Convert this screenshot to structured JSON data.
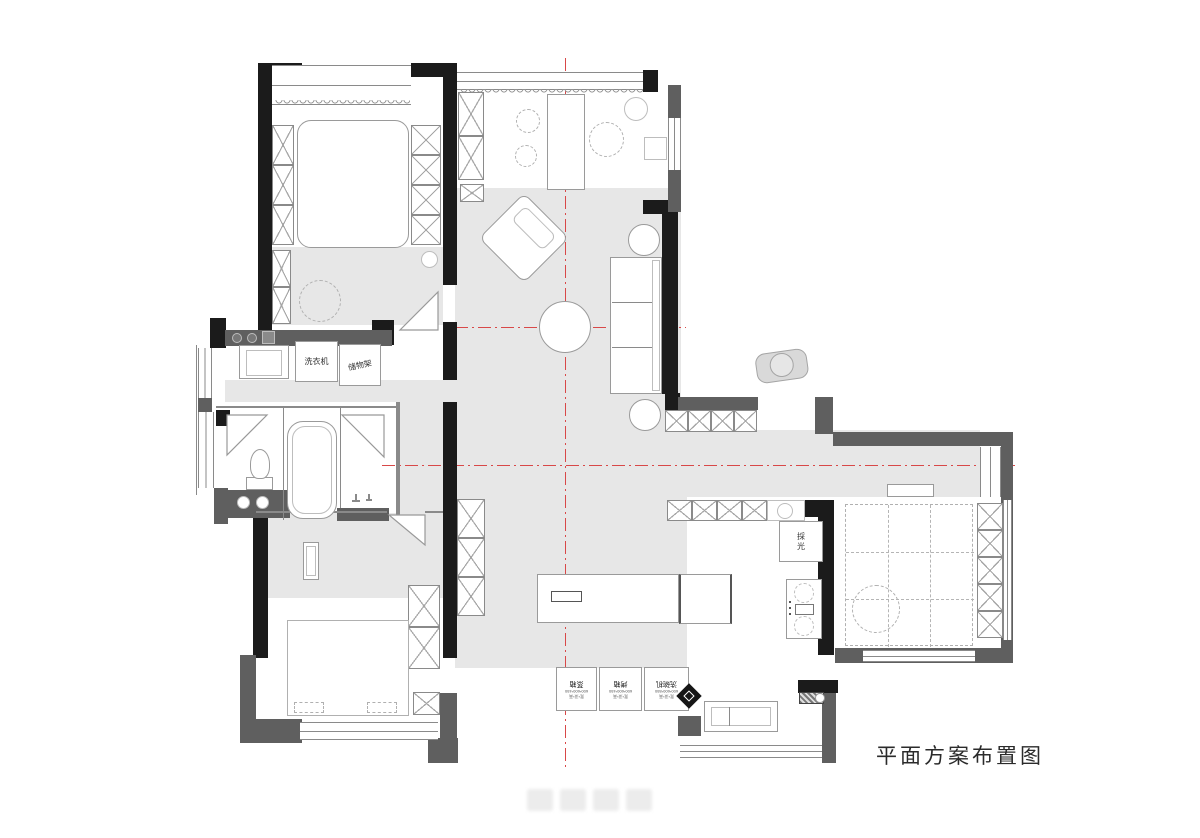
{
  "title": "平面方案布置图",
  "labels": {
    "washing_machine": "洗衣机",
    "storage_rack": "储物架",
    "daylight": "採光",
    "appliances": [
      {
        "spec": "宽*深*高",
        "dims": "600*600*450",
        "name": "蒸箱"
      },
      {
        "spec": "宽*深*高",
        "dims": "600*600*450",
        "name": "烤箱"
      },
      {
        "spec": "宽*深*高",
        "dims": "600*600*850",
        "name": "洗碗机"
      }
    ]
  },
  "colors": {
    "wall_primary": "#1b1b1b",
    "wall_secondary": "#5f5f5f",
    "floor_shade": "#e7e7e7",
    "centerline_red": "#d84848",
    "furniture_outline": "#9a9a9a"
  }
}
